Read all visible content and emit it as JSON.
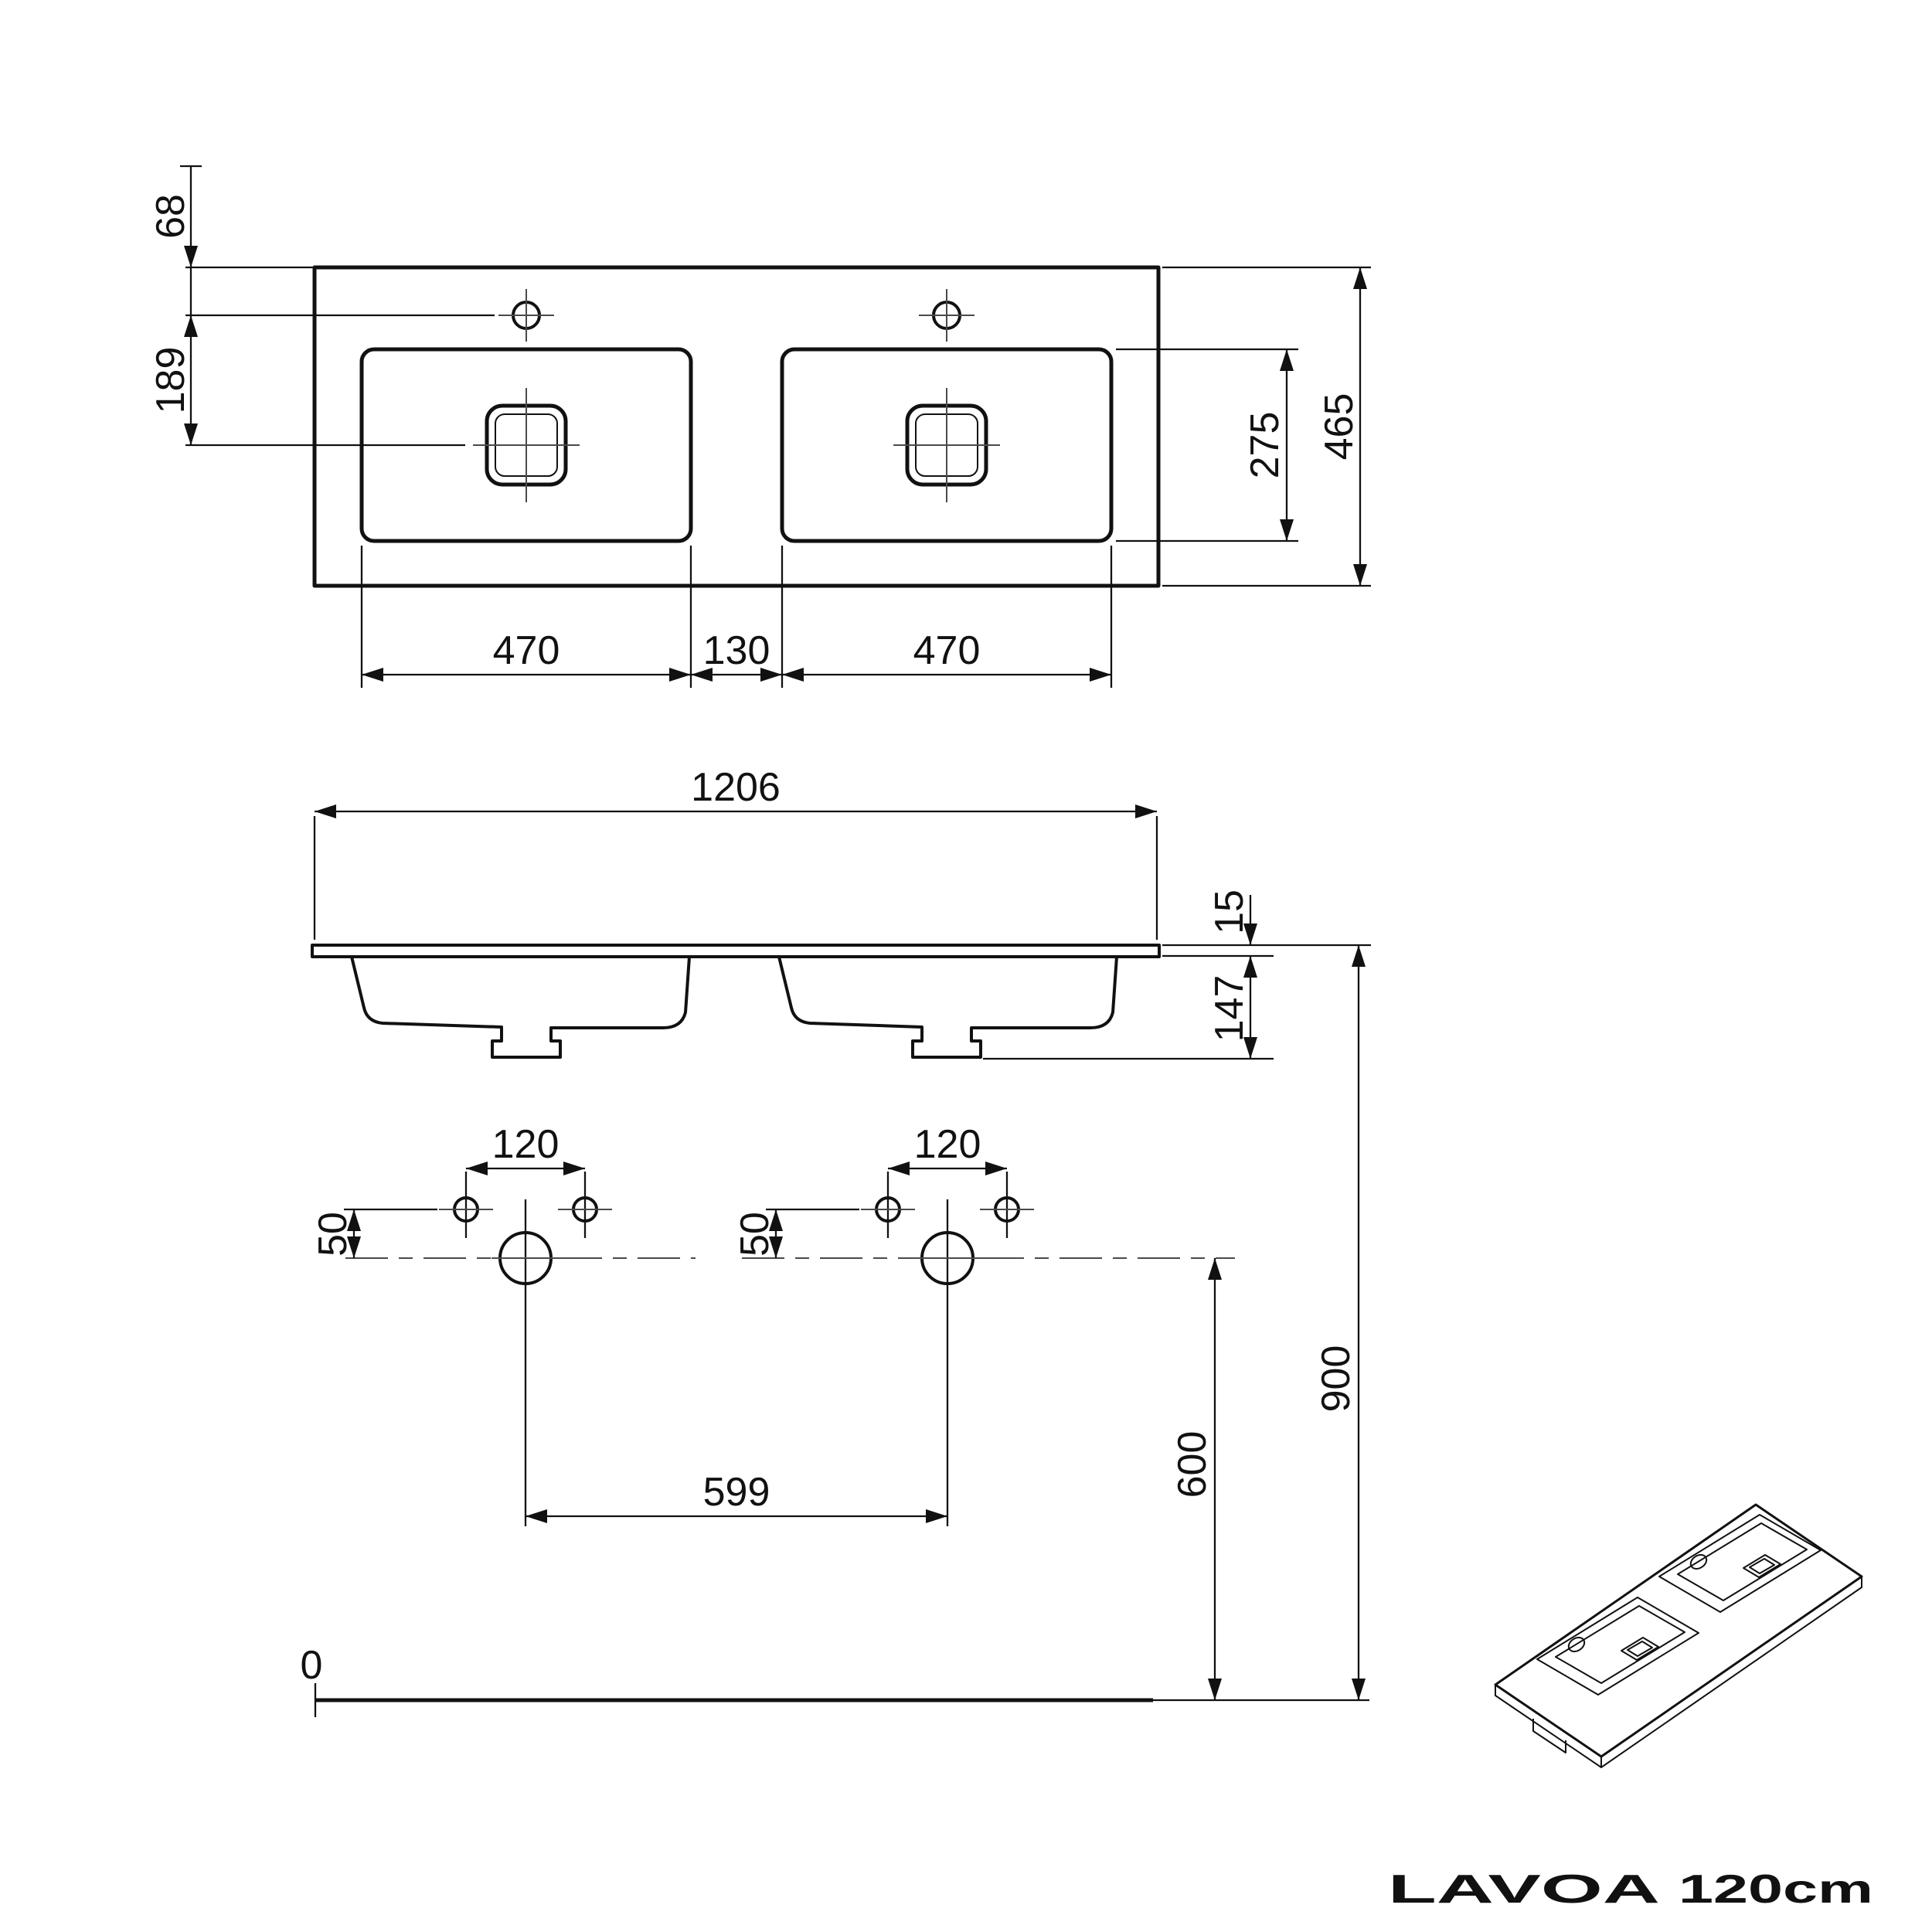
{
  "title": {
    "brand": "LAVOA",
    "size": "120cm"
  },
  "dims": {
    "plan": {
      "edge_to_faucet": "68",
      "faucet_to_drain": "189",
      "left_basin_width": "470",
      "basin_gap": "130",
      "right_basin_width": "470",
      "basin_depth": "275",
      "total_depth": "465"
    },
    "front": {
      "total_width": "1206",
      "top_thickness": "15",
      "basin_height": "147"
    },
    "template": {
      "left_tap_spacing": "120",
      "right_tap_spacing": "120",
      "left_tap_drop": "50",
      "right_tap_drop": "50",
      "drain_spacing": "599",
      "drain_height": "600",
      "rim_height": "900",
      "floor_level": "0"
    }
  }
}
